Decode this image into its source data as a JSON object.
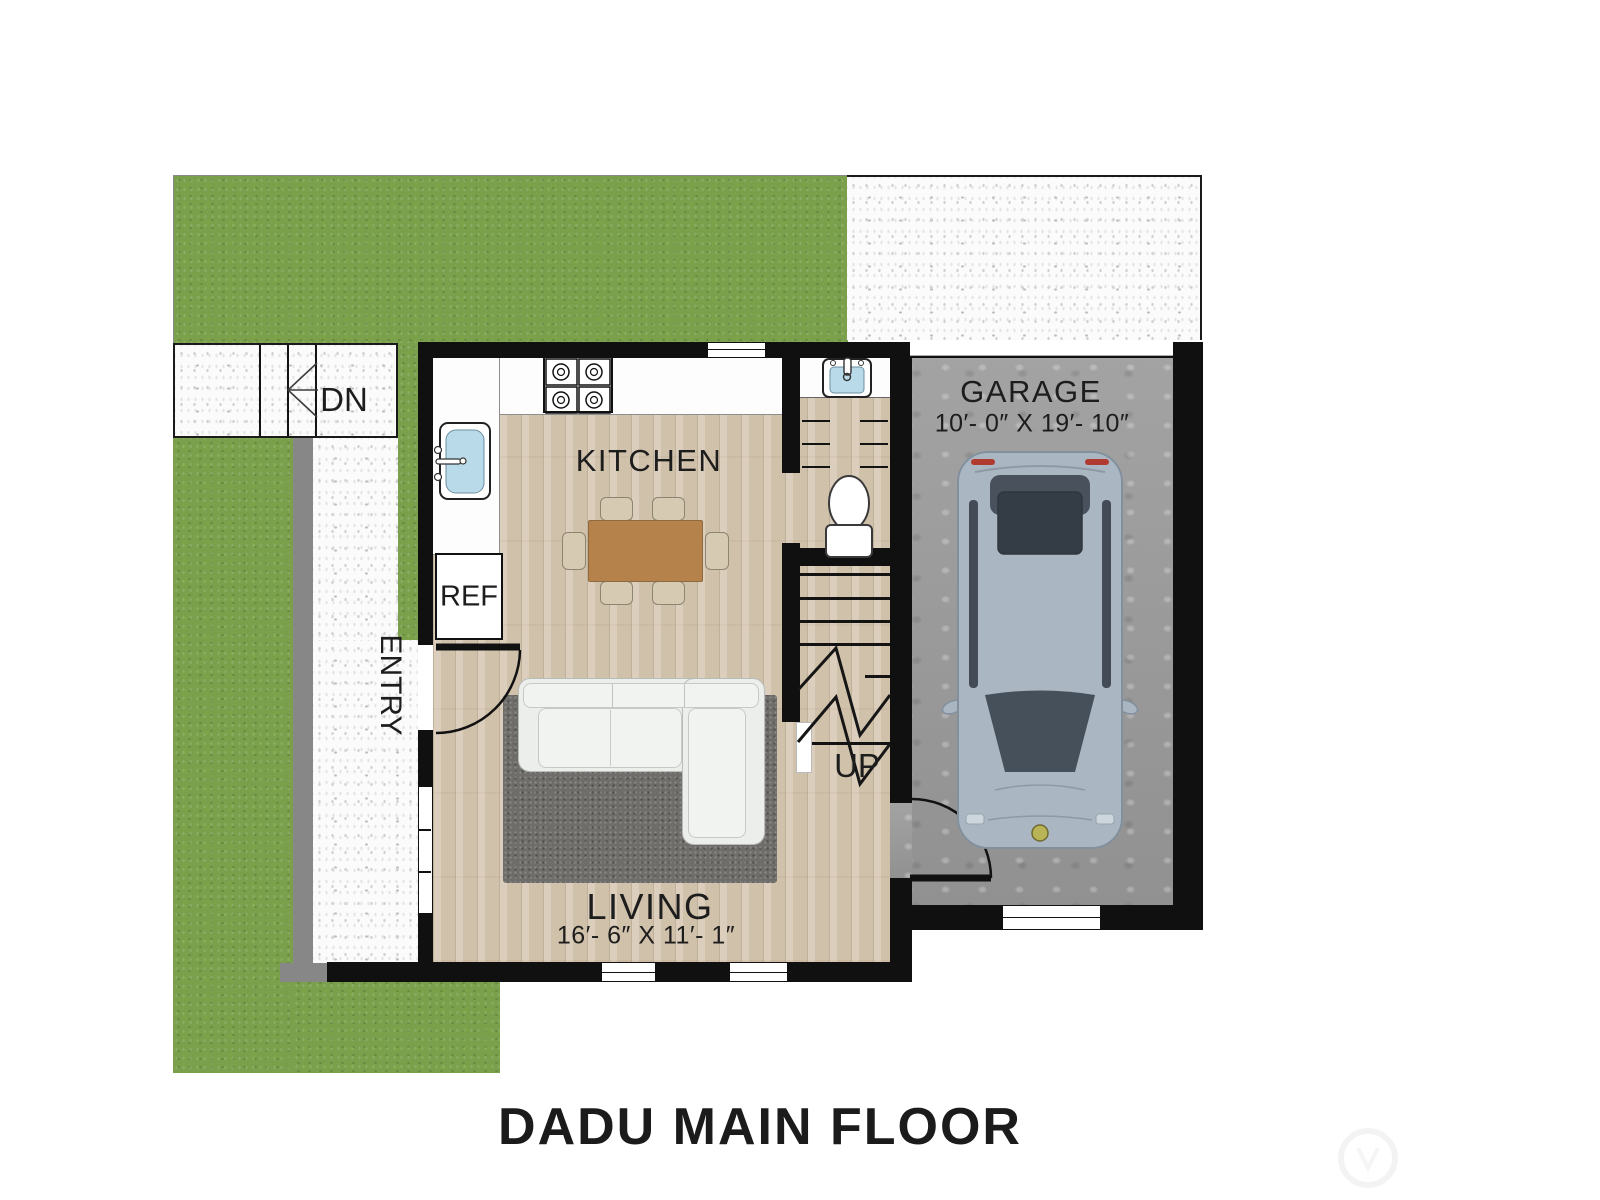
{
  "title": "DADU MAIN FLOOR",
  "labels": {
    "kitchen": "KITCHEN",
    "living": "LIVING",
    "living_dims": "16′- 6″ X 11′- 1″",
    "garage": "GARAGE",
    "garage_dims": "10′- 0″ X 19′- 10″",
    "entry": "ENTRY",
    "refrigerator": "REF",
    "stairs_down": "DN",
    "stairs_up": "UP"
  },
  "colors": {
    "grass": "#7aa04c",
    "walkway": "#fbfbfb",
    "wall": "#101010",
    "wood_floor": "#d7c9b4",
    "garage_concrete": "#9c9c9c",
    "sink_basin": "#b9dae8",
    "rug": "#6f6d6a",
    "table": "#b5824c",
    "car_body": "#aab6c1"
  }
}
